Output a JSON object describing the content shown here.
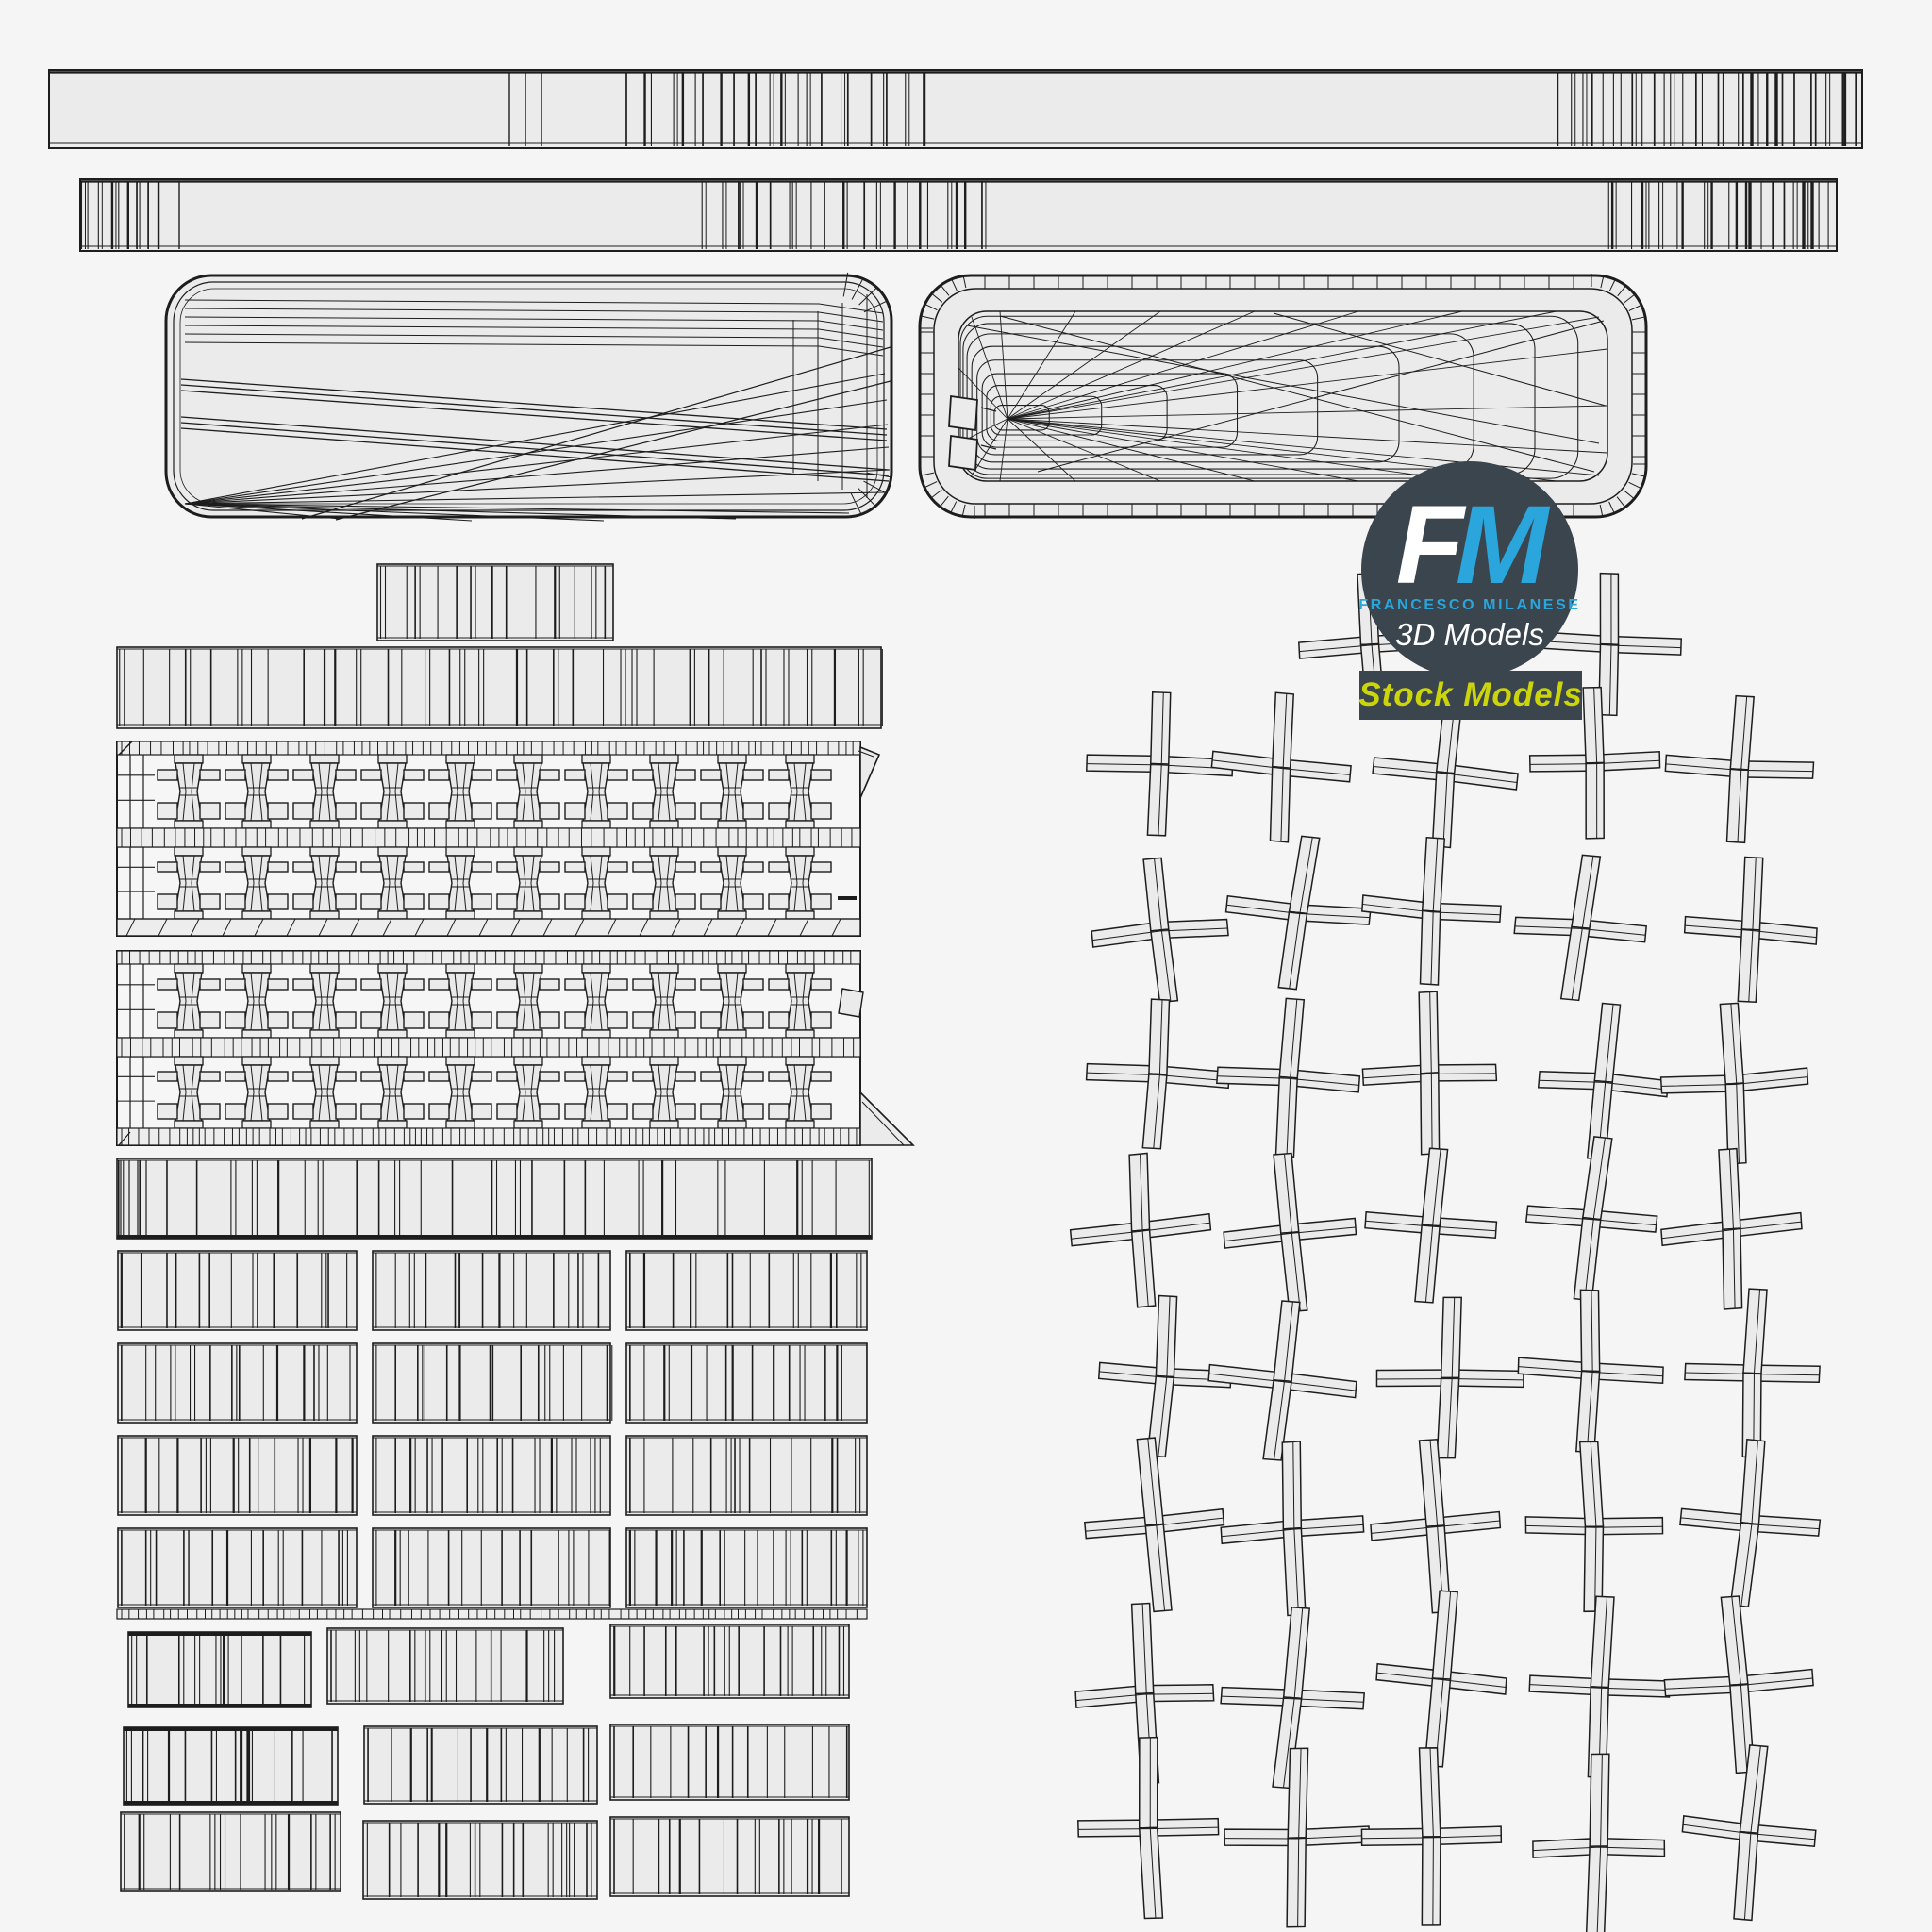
{
  "page": {
    "background": "#f5f5f6"
  },
  "logo": {
    "letter_f": "F",
    "letter_m": "M",
    "owner_caps": "FRANCESCO MILANESE",
    "subtitle": "3D Models",
    "badge_label": "Stock Models",
    "colors": {
      "circle_bg": "#3b454e",
      "accent_blue": "#2aa6dc",
      "badge_bg": "#3b454e",
      "badge_text": "#ccd40a",
      "letter_f": "#ffffff",
      "subtitle_text": "#ffffff"
    }
  },
  "wireframe": {
    "stroke_color": "#1d1d1d",
    "fill_color": "#ebebec",
    "band_fill": "#f6f6f7",
    "strip_fill": "#ededee",
    "parts": [
      {
        "name": "top-strip-a"
      },
      {
        "name": "top-strip-b"
      },
      {
        "name": "shell-top-panel"
      },
      {
        "name": "shell-bottom-tub"
      },
      {
        "name": "key-plate-band-upper"
      },
      {
        "name": "key-plate-band-lower"
      },
      {
        "name": "key-row-strips"
      },
      {
        "name": "key-row-grid"
      },
      {
        "name": "scissor-cross-grid"
      },
      {
        "name": "loose-fragments"
      }
    ]
  }
}
